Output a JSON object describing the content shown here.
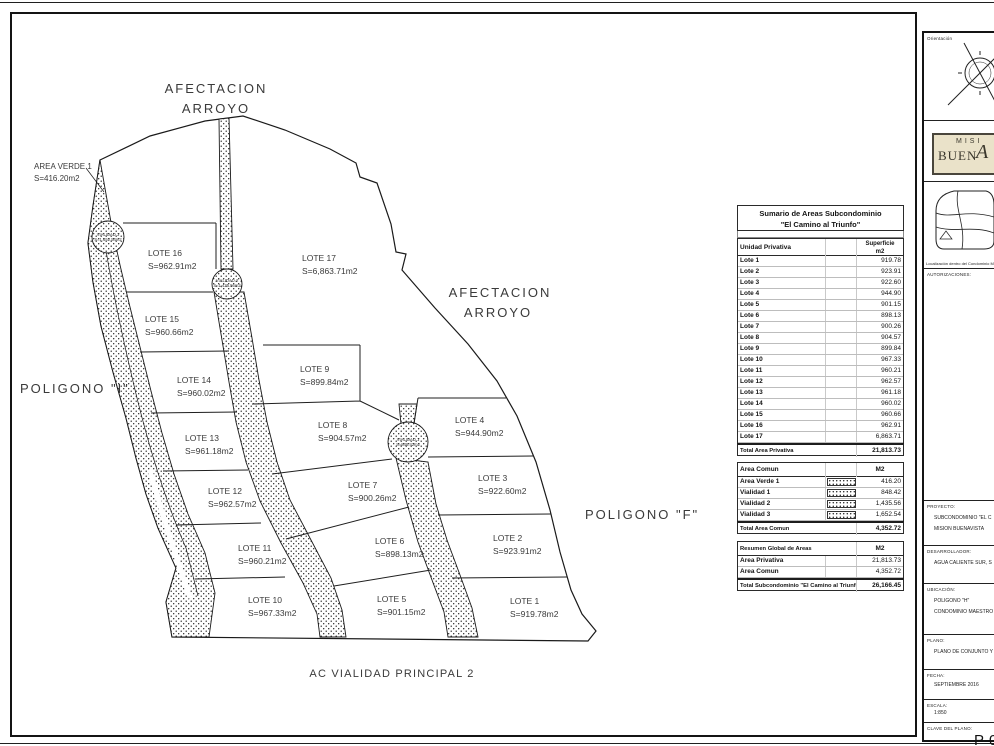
{
  "colors": {
    "line": "#1a1a1a",
    "logo_bg": "#eae2c9",
    "logo_text": "#3a372c"
  },
  "plan": {
    "labels": {
      "afectacion_top": [
        "AFECTACION",
        "ARROYO"
      ],
      "afectacion_mid": [
        "AFECTACION",
        "ARROYO"
      ],
      "poligono_i": "POLIGONO \"I\"",
      "poligono_f": "POLIGONO \"F\"",
      "vialidad_principal": "AC VIALIDAD PRINCIPAL 2",
      "area_verde_name": "AREA VERDE 1",
      "area_verde_area": "S=416.20m2"
    },
    "vialidades": [
      {
        "name": "VIALIDAD 3",
        "area": "S=1,652.54m2"
      },
      {
        "name": "VIALIDAD 2",
        "area": "S=1,435.56m2"
      },
      {
        "name": "VIALIDAD 1",
        "area": "S=848.42m2"
      }
    ],
    "lots": [
      {
        "name": "LOTE 1",
        "area": "S=919.78m2"
      },
      {
        "name": "LOTE 2",
        "area": "S=923.91m2"
      },
      {
        "name": "LOTE 3",
        "area": "S=922.60m2"
      },
      {
        "name": "LOTE 4",
        "area": "S=944.90m2"
      },
      {
        "name": "LOTE 5",
        "area": "S=901.15m2"
      },
      {
        "name": "LOTE 6",
        "area": "S=898.13m2"
      },
      {
        "name": "LOTE 7",
        "area": "S=900.26m2"
      },
      {
        "name": "LOTE 8",
        "area": "S=904.57m2"
      },
      {
        "name": "LOTE 9",
        "area": "S=899.84m2"
      },
      {
        "name": "LOTE 10",
        "area": "S=967.33m2"
      },
      {
        "name": "LOTE 11",
        "area": "S=960.21m2"
      },
      {
        "name": "LOTE 12",
        "area": "S=962.57m2"
      },
      {
        "name": "LOTE 13",
        "area": "S=961.18m2"
      },
      {
        "name": "LOTE 14",
        "area": "S=960.02m2"
      },
      {
        "name": "LOTE 15",
        "area": "S=960.66m2"
      },
      {
        "name": "LOTE 16",
        "area": "S=962.91m2"
      },
      {
        "name": "LOTE 17",
        "area": "S=6,863.71m2"
      }
    ]
  },
  "table": {
    "title1": "Sumario de Areas Subcondominio",
    "title2": "\"El Camino al Triunfo\"",
    "col_label": "Unidad Privativa",
    "col_value1": "Superficie",
    "col_value2": "m2",
    "rows": [
      {
        "label": "Lote 1",
        "value": "919.78"
      },
      {
        "label": "Lote 2",
        "value": "923.91"
      },
      {
        "label": "Lote 3",
        "value": "922.60"
      },
      {
        "label": "Lote 4",
        "value": "944.90"
      },
      {
        "label": "Lote 5",
        "value": "901.15"
      },
      {
        "label": "Lote 6",
        "value": "898.13"
      },
      {
        "label": "Lote 7",
        "value": "900.26"
      },
      {
        "label": "Lote 8",
        "value": "904.57"
      },
      {
        "label": "Lote 9",
        "value": "899.84"
      },
      {
        "label": "Lote 10",
        "value": "967.33"
      },
      {
        "label": "Lote 11",
        "value": "960.21"
      },
      {
        "label": "Lote 12",
        "value": "962.57"
      },
      {
        "label": "Lote 13",
        "value": "961.18"
      },
      {
        "label": "Lote 14",
        "value": "960.02"
      },
      {
        "label": "Lote 15",
        "value": "960.66"
      },
      {
        "label": "Lote 16",
        "value": "962.91"
      },
      {
        "label": "Lote 17",
        "value": "6,863.71"
      }
    ],
    "total_privativa": {
      "label": "Total Area Privativa",
      "value": "21,813.73"
    },
    "comun": {
      "header": "Area Comun",
      "unit": "M2",
      "rows": [
        {
          "label": "Area Verde 1",
          "value": "416.20"
        },
        {
          "label": "Vialidad 1",
          "value": "848.42"
        },
        {
          "label": "Vialidad 2",
          "value": "1,435.56"
        },
        {
          "label": "Vialidad 3",
          "value": "1,652.54"
        }
      ],
      "total": {
        "label": "Total Area Comun",
        "value": "4,352.72"
      }
    },
    "resumen": {
      "header": "Resumen Global de Areas",
      "unit": "M2",
      "rows": [
        {
          "label": "Area Privativa",
          "value": "21,813.73"
        },
        {
          "label": "Area Comun",
          "value": "4,352.72"
        }
      ],
      "total": {
        "label": "Total Subcondominio \"El Camino al Triunfo\"",
        "value": "26,166.45"
      }
    }
  },
  "titleblock": {
    "orientacion_label": "Orientación",
    "logo": {
      "line1": "MISI",
      "line2": "BUEN",
      "flourish": "A"
    },
    "map_caption": "Localización dentro del Condominio Ma",
    "autorizaciones_label": "AUTORIZACIONES:",
    "fields": [
      {
        "label": "PROYECTO:",
        "line1": "SUBCONDOMINIO \"EL C",
        "line2": "MISION BUENAVISTA"
      },
      {
        "label": "DESARROLLADOR:",
        "line1": "AGUA CALIENTE SUR, S"
      },
      {
        "label": "UBICACIÓN:",
        "line1": "POLIGONO \"H\"",
        "line2": "CONDOMINIO MAESTRO"
      },
      {
        "label": "PLANO:",
        "line1": "PLANO DE CONJUNTO Y"
      },
      {
        "label": "FECHA:",
        "line1": "SEPTIEMBRE 2016"
      },
      {
        "label": "ESCALA:",
        "line1": "1:850"
      },
      {
        "label": "CLAVE DEL PLANO:"
      }
    ],
    "clave": "P-0"
  }
}
